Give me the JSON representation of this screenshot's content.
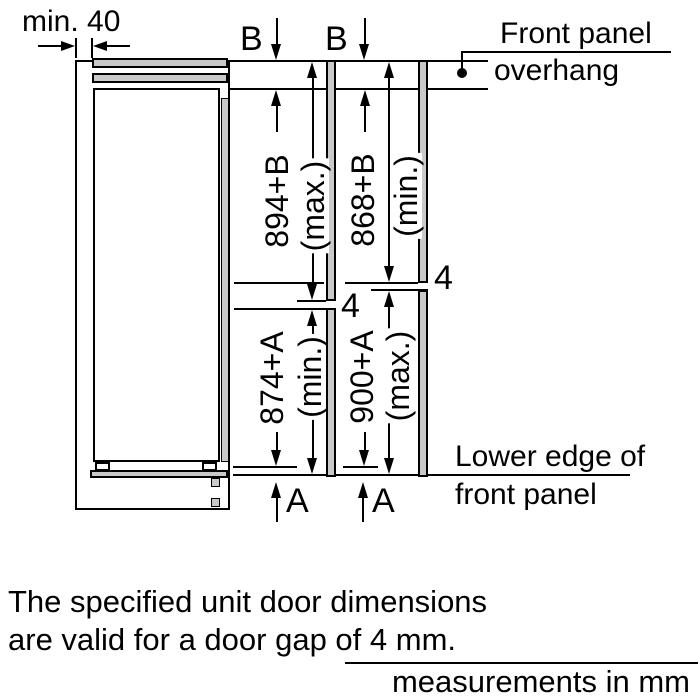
{
  "diagram": {
    "min_clearance": "min. 40",
    "overhang_top_label": "B",
    "overhang_bottom_label": "A",
    "door_gap": "4",
    "dims": {
      "top_max": "894+B",
      "top_max_q": "(max.)",
      "top_min": "868+B",
      "top_min_q": "(min.)",
      "bottom_min": "874+A",
      "bottom_min_q": "(min.)",
      "bottom_max": "900+A",
      "bottom_max_q": "(max.)"
    },
    "front_panel_overhang_line1": "Front panel",
    "front_panel_overhang_line2": "overhang",
    "lower_edge_line1": "Lower edge of",
    "lower_edge_line2": "front panel"
  },
  "notes": {
    "line1": "The specified unit door dimensions",
    "line2": "are valid for a door gap of 4 mm.",
    "units": "measurements in mm"
  },
  "colors": {
    "line": "#000000",
    "panel_fill": "#c9c9c9",
    "background": "#ffffff"
  }
}
